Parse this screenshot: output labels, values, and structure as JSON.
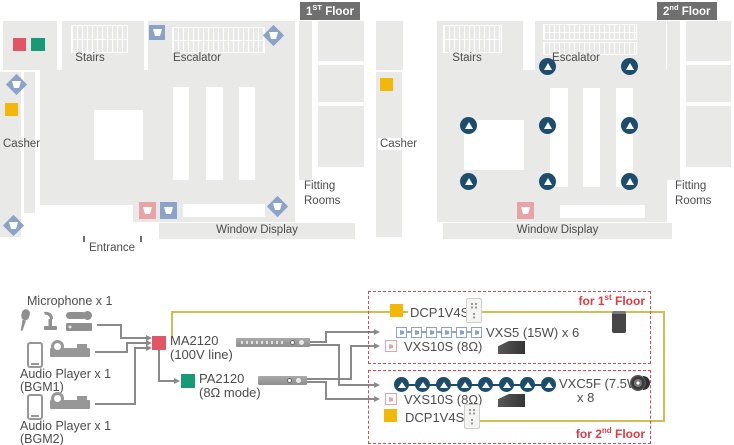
{
  "floor1": {
    "badge": {
      "num": "1",
      "sup": "ST",
      "rest": " Floor"
    },
    "labels": {
      "stairs": "Stairs",
      "escalator": "Escalator",
      "casher": "Casher",
      "fitting_line1": "Fitting",
      "fitting_line2": "Rooms",
      "window_display": "Window Display",
      "entrance": "Entrance"
    },
    "marker_counts": {
      "vxs5_corner_diamond": 4,
      "vxs5_wall_square": 2,
      "vxs10s": 1,
      "ma2120": 1,
      "pa2120": 1,
      "dcp1v4s": 1
    }
  },
  "floor2": {
    "badge": {
      "num": "2",
      "sup": "nd",
      "rest": " Floor"
    },
    "labels": {
      "stairs": "Stairs",
      "escalator": "Escalator",
      "casher": "Casher",
      "fitting_line1": "Fitting",
      "fitting_line2": "Rooms",
      "window_display": "Window Display"
    },
    "marker_counts": {
      "vxc5f_ceiling": 8,
      "vxs10s": 1,
      "dcp1v4s": 1
    }
  },
  "sources": {
    "microphone_label": "Microphone x 1",
    "bgm1_label": "Audio Player x 1",
    "bgm1_sub": "(BGM1)",
    "bgm2_label": "Audio Player x 1",
    "bgm2_sub": "(BGM2)"
  },
  "amps": {
    "ma2120_name": "MA2120",
    "ma2120_mode": "(100V line)",
    "pa2120_name": "PA2120",
    "pa2120_mode": "(8Ω mode)"
  },
  "zone1": {
    "tag": {
      "prefix": "for 1",
      "sup": "st",
      "rest": " Floor"
    },
    "dcp_label": "DCP1V4S",
    "vxs5_label": "VXS5 (15W) x 6",
    "vxs5_count": 6,
    "vxs10s_label": "VXS10S (8Ω)"
  },
  "zone2": {
    "tag": {
      "prefix": "for 2",
      "sup": "nd",
      "rest": " Floor"
    },
    "dcp_label": "DCP1V4S",
    "vxc5f_label": "VXC5F (7.5W)",
    "vxc5f_qty": "x 8",
    "vxc5f_count": 8,
    "vxs10s_label": "VXS10S (8Ω)"
  },
  "icons": {
    "ma2120_marker": "red-square",
    "pa2120_marker": "green-square",
    "dcp1v4s_marker": "yellow-square",
    "vxs5_marker": "blue-square-speaker / blue-diamond-speaker",
    "vxs10s_marker": "pink-square-speaker",
    "vxc5f_marker": "navy-circle-triangle"
  },
  "colors": {
    "floor_gray": "#e9e9e7",
    "badge_gray": "#6f6f6f",
    "red": "#e25565",
    "green": "#179b77",
    "yellow": "#f2b707",
    "blue": "#8ba2c9",
    "pink": "#e9a3a7",
    "navy": "#1d4d6d",
    "dashed_red": "#e0454d",
    "tag_red": "#e03a43",
    "wire_gray": "#8a8a8a",
    "control_yellow": "#d2bd55"
  }
}
